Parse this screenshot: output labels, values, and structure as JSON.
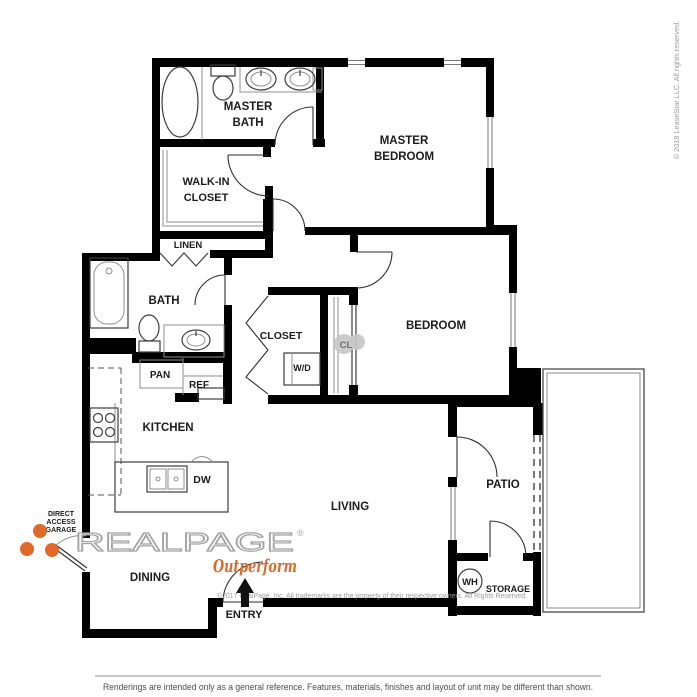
{
  "plan": {
    "rooms": {
      "master_bath": [
        "MASTER",
        "BATH"
      ],
      "master_bedroom": [
        "MASTER",
        "BEDROOM"
      ],
      "walk_in_closet": [
        "WALK-IN",
        "CLOSET"
      ],
      "linen": "LINEN",
      "bath": "BATH",
      "bedroom": "BEDROOM",
      "closet": "CLOSET",
      "cl": "CL",
      "wd": "W/D",
      "pan": "PAN",
      "ref": "REF",
      "kitchen": "KITCHEN",
      "dw": "DW",
      "living": "LIVING",
      "dining": "DINING",
      "patio": "PATIO",
      "wh": "WH",
      "storage": "STORAGE",
      "entry": "ENTRY"
    },
    "garage_note": [
      "DIRECT",
      "ACCESS",
      "GARAGE"
    ]
  },
  "watermark": {
    "brand": "REALPAGE",
    "registered": "®",
    "tagline": "Outperform",
    "copyright": "©2017 RealPage, Inc.  All trademarks are the property of their respective owners. All Rights Reserved."
  },
  "sidebar_note": "© 2018 LeaseStar LLC. All rights reserved.",
  "footer": {
    "disclaimer": "Renderings are intended only as a general reference. Features, materials, finishes and layout of unit may be different than shown."
  },
  "colors": {
    "wall": "#000000",
    "accent_orange": "#dd6a2b",
    "watermark_gray": "#a3a3a3",
    "footnote_gray": "#9b9b9b"
  }
}
